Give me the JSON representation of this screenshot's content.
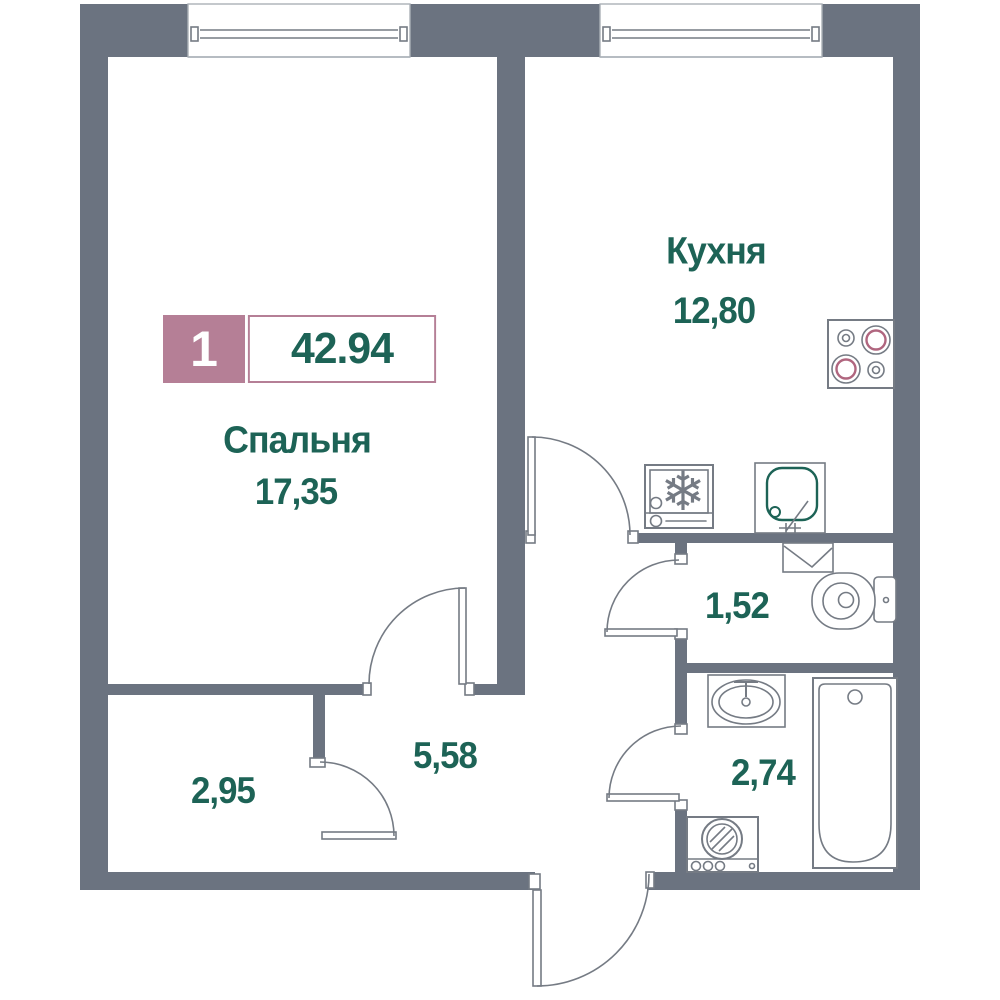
{
  "floorplan": {
    "badge": {
      "room_count": "1",
      "total_area": "42.94"
    },
    "rooms": {
      "bedroom": {
        "name": "Спальня",
        "area": "17,35"
      },
      "kitchen": {
        "name": "Кухня",
        "area": "12,80"
      },
      "toilet": {
        "area": "1,52"
      },
      "bathroom": {
        "area": "2,74"
      },
      "hallway": {
        "area": "5,58"
      },
      "closet": {
        "area": "2,95"
      }
    },
    "icons": {
      "fridge_snowflake_glyph": "❄"
    },
    "colors": {
      "wall": "#6b7380",
      "outline": "#757b84",
      "accent_pink": "#b57f96",
      "text_teal": "#1d6356",
      "burner_pink": "#b0667f"
    }
  }
}
